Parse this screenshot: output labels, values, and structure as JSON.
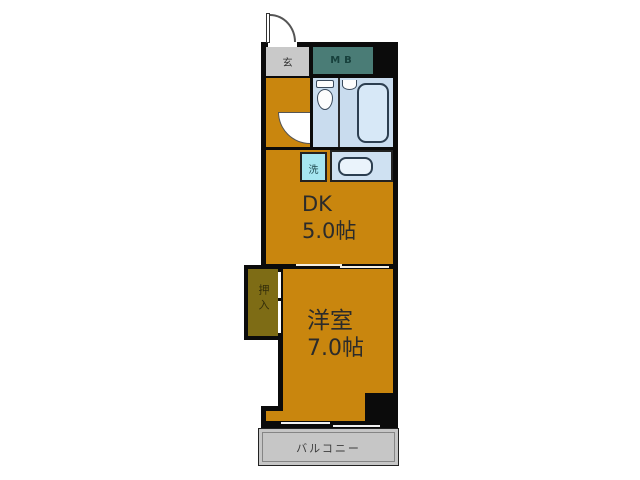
{
  "floorplan": {
    "entrance": {
      "label": "玄"
    },
    "meter_box": {
      "label": "MB"
    },
    "laundry": {
      "label": "洗"
    },
    "dk": {
      "label": "DK",
      "area": "5.0帖"
    },
    "western_room": {
      "label": "洋室",
      "area": "7.0帖"
    },
    "closet": {
      "label": "押入"
    },
    "balcony": {
      "label": "バルコニー"
    },
    "colors": {
      "floor_orange": "#C9860E",
      "closet_olive": "#7E6C15",
      "meter_box_teal": "#4A7C76",
      "bathroom_blue": "#C9DCEE",
      "laundry_cyan": "#A6E6F0",
      "counter_blue": "#CFE1F2",
      "entrance_gray": "#C9C9C9",
      "balcony_gray": "#C6C6C6",
      "wall_black": "#0B0B0B"
    }
  }
}
